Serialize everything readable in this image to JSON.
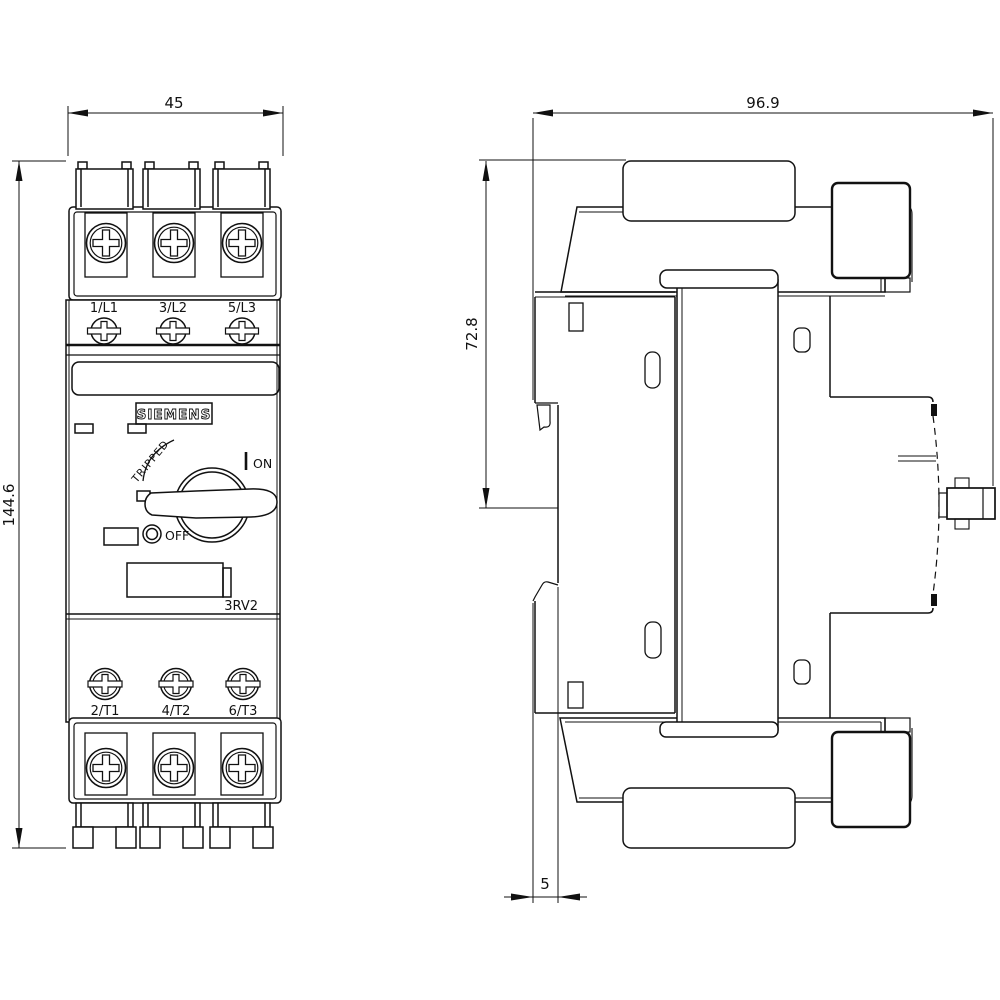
{
  "drawing": {
    "brand": "SIEMENS",
    "product_code": "3RV2",
    "front_view": {
      "terminals_top": [
        "1/L1",
        "3/L2",
        "5/L3"
      ],
      "terminals_bottom": [
        "2/T1",
        "4/T2",
        "6/T3"
      ],
      "switch": {
        "on": "ON",
        "off": "OFF",
        "tripped": "TRIPPED"
      }
    },
    "dimensions": {
      "width": "45",
      "height": "144.6",
      "depth": "96.9",
      "upper_depth": "72.8",
      "rail_clip": "5"
    }
  }
}
